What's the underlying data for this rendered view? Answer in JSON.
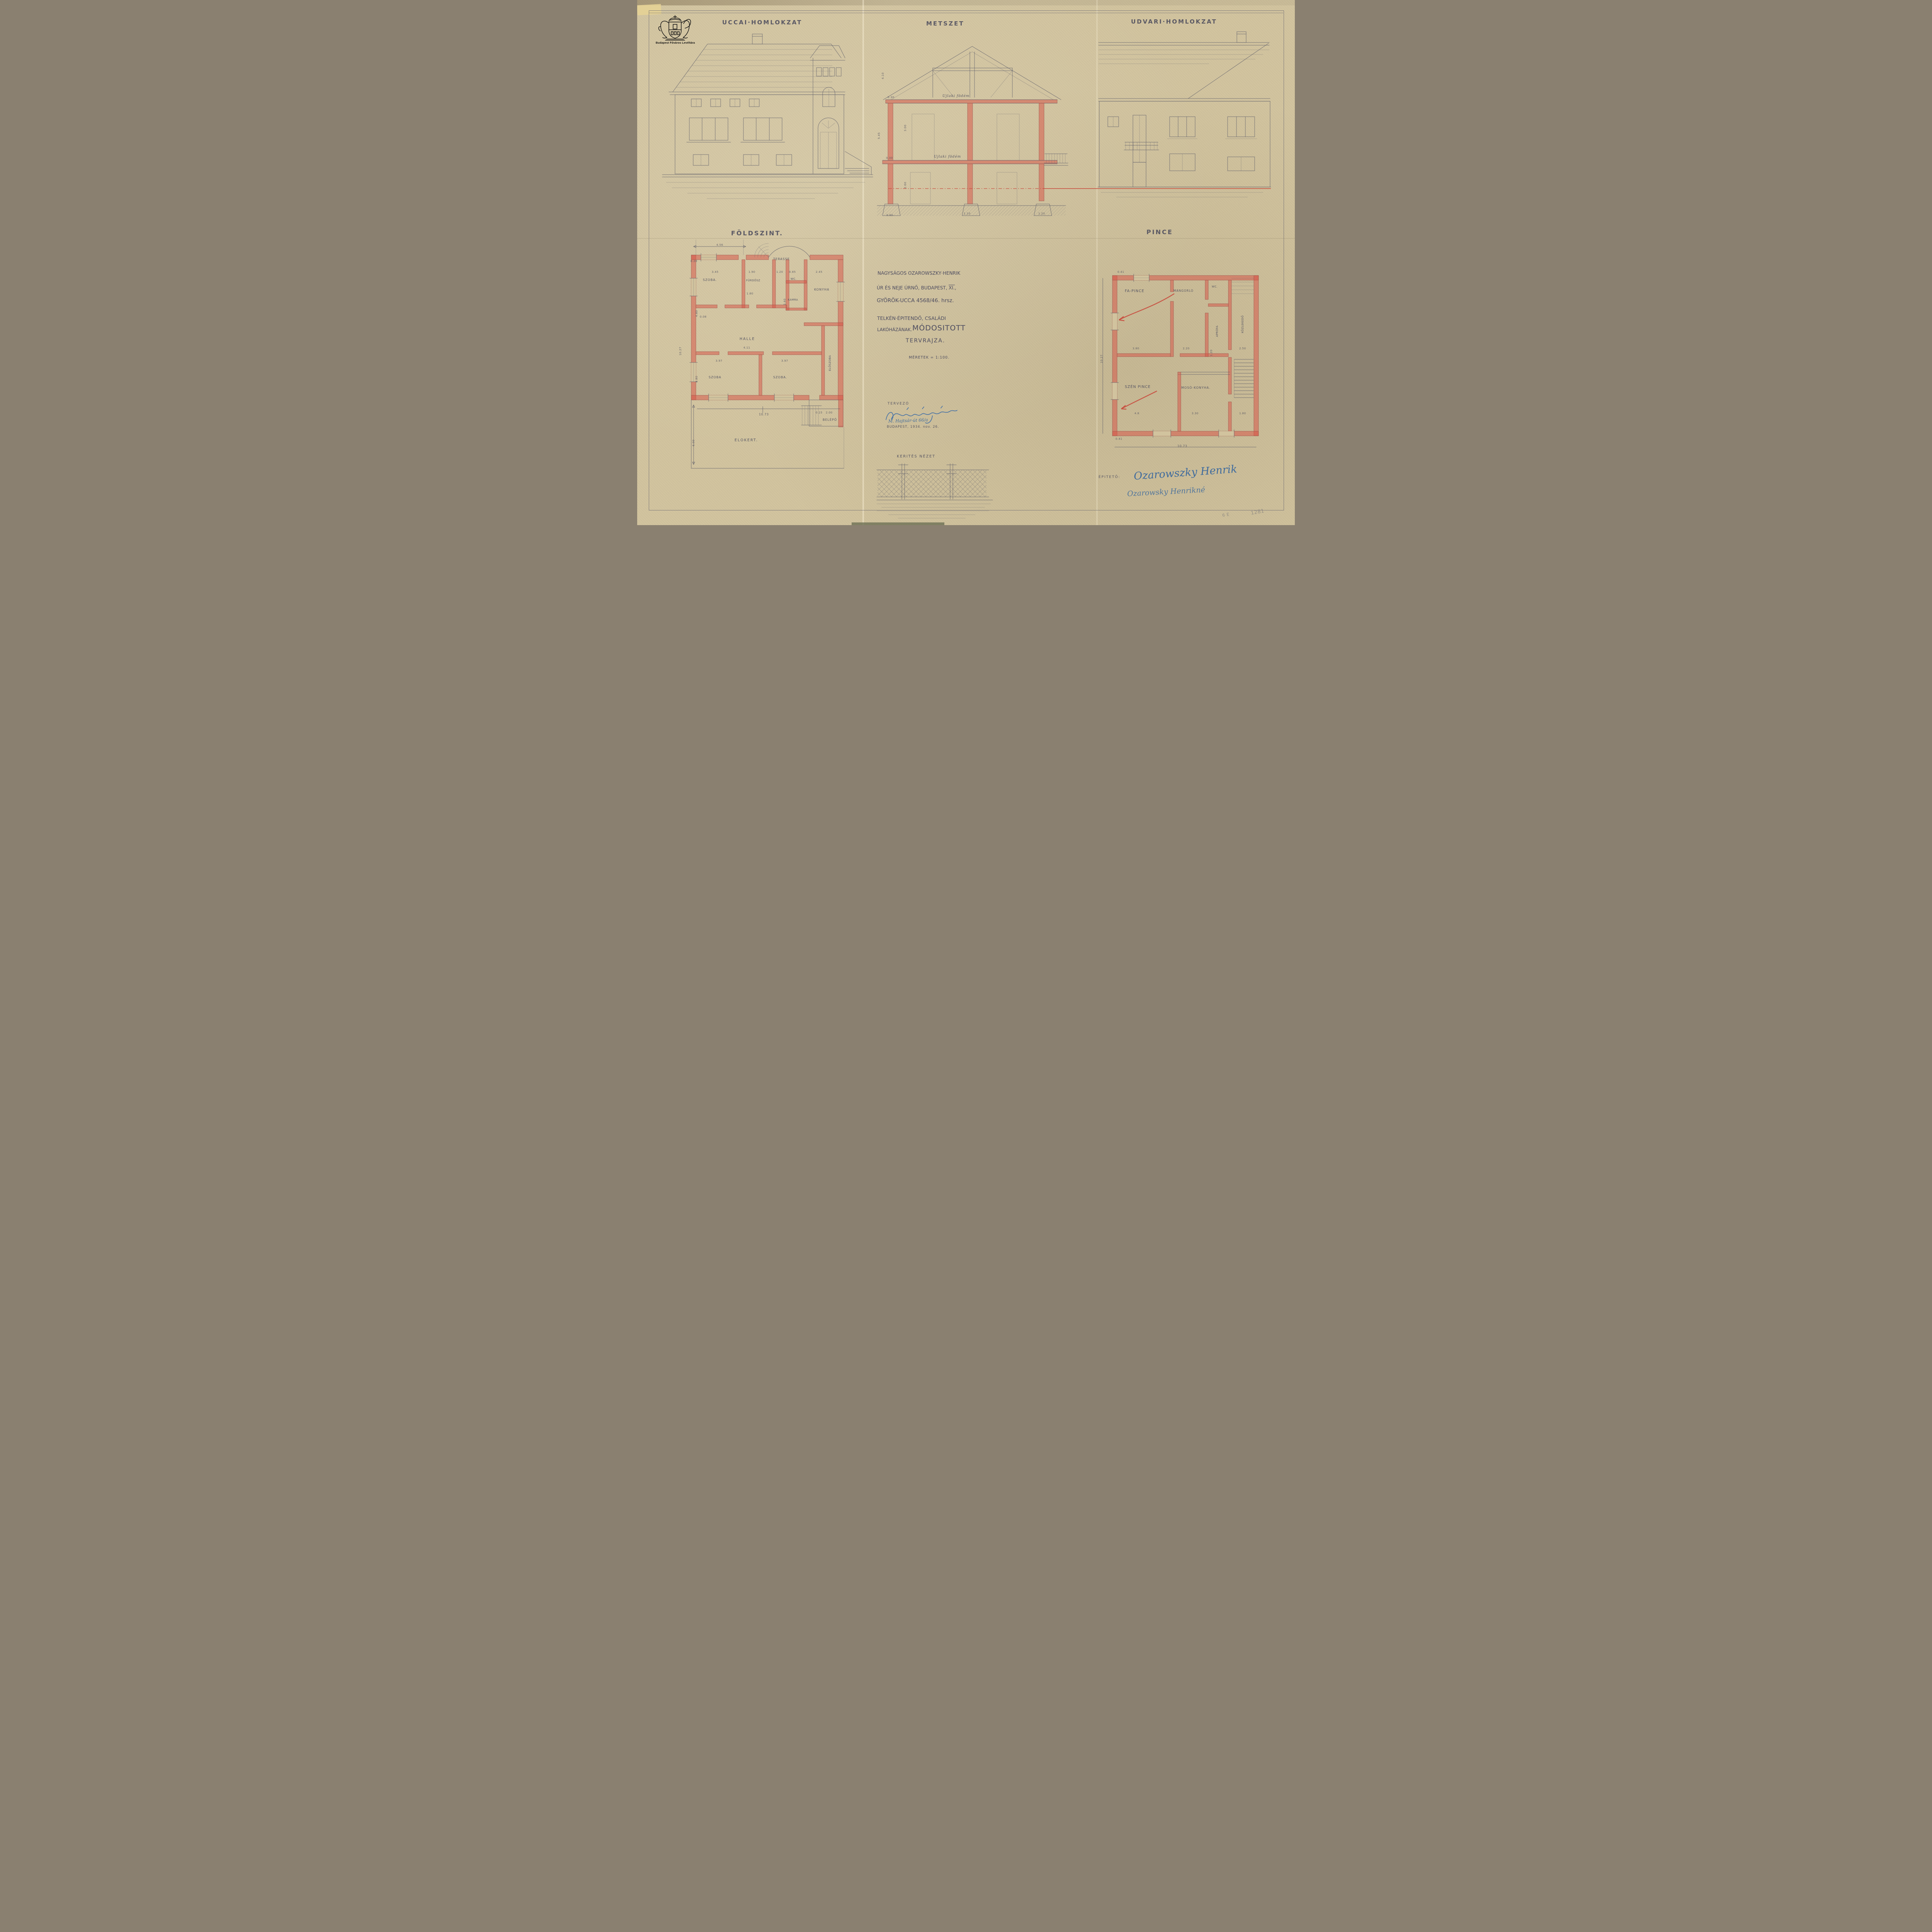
{
  "stamp": {
    "name": "Budapest Főváros Levéltára"
  },
  "titles": {
    "street": "UCCAI·HOMLOKZAT",
    "section": "METSZET",
    "courtyard": "UDVARI·HOMLOKZAT",
    "ground_floor": "FÖLDSZINT.",
    "basement": "PINCE"
  },
  "section": {
    "slab_upper": "Ujlaki födém",
    "slab_lower": "Ujlaki födém",
    "dims": {
      "roof_h": "4.10",
      "total_h": "5.45",
      "slab1": "0.30",
      "storey": "3.00",
      "slab2": "0.30",
      "ground": "2.60",
      "f_left": "0.60",
      "f_mid": "1.10",
      "f_right": "1.20"
    }
  },
  "gf": {
    "rooms": {
      "terrace": "TERASSE",
      "room_tl": "SZOBA.",
      "bath": "FÜRDŐSZ",
      "wc": "WC.",
      "pantry": "KAMRA",
      "kitchen": "KONYHA",
      "hall": "HALLE",
      "room_bl": "SZOBA",
      "room_br": "SZOBA.",
      "vestibule": "ELŐSZOBA",
      "entry": "BELÉPŐ",
      "garden": "ELŐKERT."
    },
    "dims": {
      "top": "4.56",
      "wall": "0.28",
      "room_tl": "3.45",
      "bath": "1.90",
      "corr": "1.20",
      "wc": "0.85",
      "kitchen": "2.45",
      "bath_d": "1.80",
      "pantry_d": "2.40",
      "hall": "4.11",
      "room_bl": "3.97",
      "room_br": "3.97",
      "height_tl": "4.80",
      "height": "4.80",
      "small": "0.08",
      "entry_w": "2.00",
      "entry_s": "0.15",
      "total_w": "10.73",
      "garden_d": "6.00",
      "left_h": "10.27"
    }
  },
  "bs": {
    "rooms": {
      "wood": "FA-PINCE",
      "mangle": "MÁNGORLÓ",
      "wc": "WC.",
      "kindling": "APRÓFA",
      "corridor": "KÖZLEKEDŐ",
      "coal": "SZÉN PINCE",
      "laundry": "MOSÓ-KONYHA."
    },
    "dims": {
      "wall_top": "0.41",
      "wood": "3.80",
      "mangle": "2.20",
      "kindling": "1.20",
      "corridor": "2.50",
      "coal": "4.8",
      "laundry": "3.30",
      "stair": "1.80",
      "total_w": "10.73",
      "left_h": "10.27",
      "wall_bottom": "0.41"
    }
  },
  "project": {
    "line1": "NAGYSÁGOS OZAROWSZKY·HENRIK",
    "line2_prefix": "ÚR ÉS NEJE ÚRNŐ, BUDAPEST,",
    "line2_district": "XI.",
    "line2_suffix": ",",
    "line3": "GYÖRÖK-UCCA 4568/46. hrsz.",
    "line4": "TELKÉN·ÉPITENDŐ, CSALÁDI",
    "line5a": "LAKÓHÁZÁNAK.",
    "line5b": "MÓDOSITOTT",
    "line6": "TERVRAJZA.",
    "scale": "MÉRETEK = 1:100."
  },
  "designer": {
    "label": "TERVEZŐ",
    "address": "M. Hajtsár-út 66/a",
    "dateline": "BUDAPEST, 1934. nov. 26."
  },
  "fence": {
    "title": "KERITÉS NÉZET"
  },
  "client": {
    "label": "ÉPITETŐ:",
    "signature1": "Ozarowszky Henrik",
    "signature2": "Ozarowsky Henrikné"
  },
  "corner": {
    "a": "6 E",
    "b": "1281"
  }
}
